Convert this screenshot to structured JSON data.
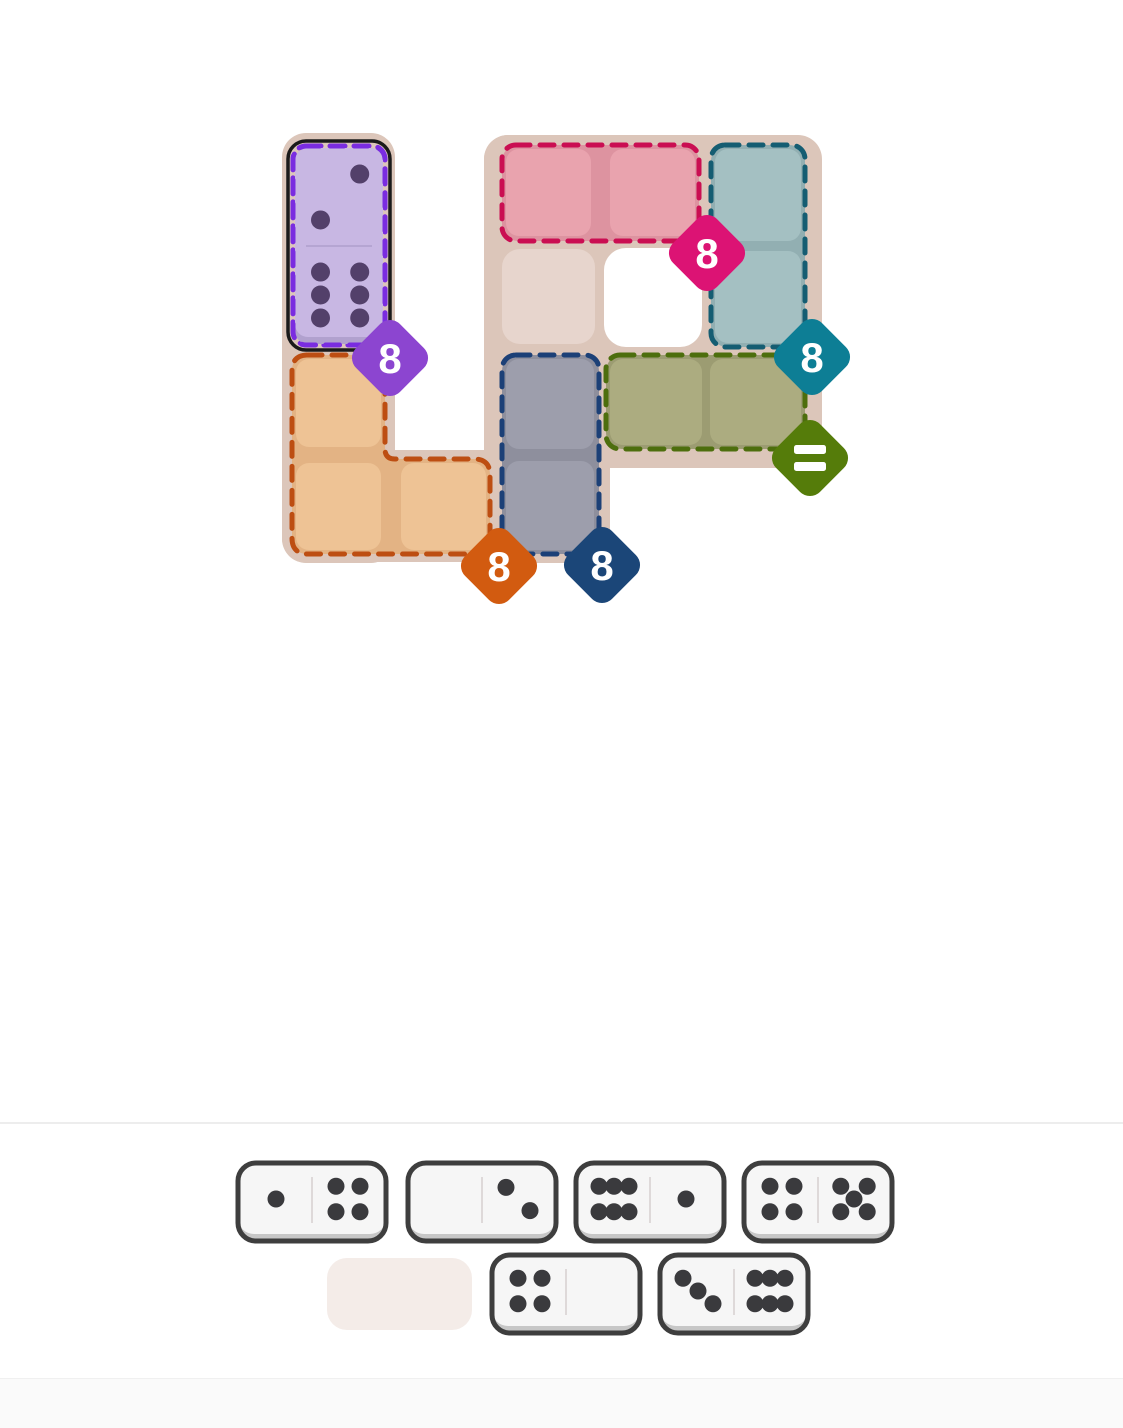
{
  "page": {
    "bg": "#ffffff"
  },
  "board": {
    "backing_color": "#dcc6ba",
    "backing_rects": [
      {
        "x": 282,
        "y": 133,
        "w": 113,
        "h": 430
      },
      {
        "x": 484,
        "y": 135,
        "w": 126,
        "h": 428
      },
      {
        "x": 484,
        "y": 135,
        "w": 338,
        "h": 333
      },
      {
        "x": 282,
        "y": 450,
        "w": 328,
        "h": 112
      }
    ],
    "hole": {
      "x": 604,
      "y": 248,
      "w": 98,
      "h": 99,
      "fill": "#ffffff"
    },
    "empty_cell": {
      "id": "cell-C2",
      "x": 502,
      "y": 249,
      "w": 93,
      "h": 95,
      "fill": "#e7d5cd"
    },
    "regions": [
      {
        "id": "purple",
        "cells": [
          "A1",
          "A2"
        ],
        "shape": "rect",
        "rect": [
          293,
          146,
          92,
          199
        ],
        "dash": "#7a2ce0",
        "selected": true,
        "selection_outline": "#1a1a1a",
        "badge": {
          "label": "8",
          "color": "#8c45d0",
          "x": 390,
          "y": 358
        }
      },
      {
        "id": "pink",
        "cells": [
          "C1",
          "D1"
        ],
        "shape": "rect",
        "rect": [
          502,
          145,
          197,
          96
        ],
        "base": "#dd93a0",
        "cell_fill": "#e9a3ae",
        "dash": "#ca0e52",
        "cells_px": [
          [
            506,
            149,
            85,
            87
          ],
          [
            610,
            149,
            85,
            87
          ]
        ],
        "badge": {
          "label": "8",
          "color": "#dc1374",
          "x": 707,
          "y": 253
        }
      },
      {
        "id": "teal",
        "cells": [
          "E1",
          "E2"
        ],
        "shape": "rect",
        "rect": [
          711,
          145,
          94,
          202
        ],
        "base": "#92afb2",
        "cell_fill": "#a4c0c2",
        "dash": "#155d72",
        "cells_px": [
          [
            715,
            149,
            86,
            92
          ],
          [
            715,
            251,
            86,
            92
          ]
        ],
        "badge": {
          "label": "8",
          "color": "#0d7e95",
          "x": 812,
          "y": 357
        }
      },
      {
        "id": "orange",
        "cells": [
          "A3",
          "A4",
          "B4"
        ],
        "shape": "path",
        "path": "M 308,355 L 369,355 Q 385,355 385,371 L 385,449 Q 385,459 395,459 L 474,459 Q 490,459 490,475 L 490,538 Q 490,554 474,554 L 308,554 Q 292,554 292,538 L 292,371 Q 292,355 308,355 Z",
        "base": "#e3b384",
        "cell_fill": "#eec395",
        "dash": "#bd4e12",
        "cells_px": [
          [
            296,
            359,
            85,
            88
          ],
          [
            296,
            463,
            85,
            87
          ],
          [
            401,
            463,
            85,
            87
          ]
        ],
        "badge": {
          "label": "8",
          "color": "#d25b10",
          "x": 499,
          "y": 566
        }
      },
      {
        "id": "navy",
        "cells": [
          "C3",
          "C4"
        ],
        "shape": "rect",
        "rect": [
          502,
          355,
          97,
          199
        ],
        "base": "#8e8f9d",
        "cell_fill": "#9d9eac",
        "dash": "#1c4077",
        "cells_px": [
          [
            506,
            359,
            88,
            90
          ],
          [
            506,
            461,
            88,
            89
          ]
        ],
        "badge": {
          "label": "8",
          "color": "#1b4678",
          "x": 602,
          "y": 565
        }
      },
      {
        "id": "olive",
        "cells": [
          "D3",
          "E3"
        ],
        "shape": "rect",
        "rect": [
          606,
          355,
          199,
          94
        ],
        "base": "#9c9c72",
        "cell_fill": "#acac80",
        "dash": "#4d6e0d",
        "cells_px": [
          [
            610,
            359,
            92,
            86
          ],
          [
            710,
            359,
            91,
            86
          ]
        ],
        "badge": {
          "label": "=",
          "color": "#557c0a",
          "x": 810,
          "y": 458
        }
      }
    ],
    "placed_domino": {
      "pips": [
        2,
        6
      ],
      "x": 295,
      "y": 148,
      "w": 88,
      "h": 196,
      "fill": "#c8b7e3",
      "lip": "#b1a1ce",
      "pip_color": "#53406a",
      "divider": "#b5a5d2",
      "selection_outline": {
        "x": 288,
        "y": 141,
        "w": 102,
        "h": 209,
        "color": "#1a1a1a"
      }
    }
  },
  "tray": {
    "style": {
      "w": 148,
      "h": 78,
      "fill": "#f6f6f6",
      "border": "#3e3e3e",
      "lip": "#c7c7c7",
      "pip": "#3a3a3d",
      "divider": "#ded9d9"
    },
    "empty_slot": {
      "x": 327,
      "y": 1258,
      "w": 145,
      "h": 72,
      "fill": "#f4ece8"
    },
    "dominoes": [
      {
        "x": 238,
        "y": 1163,
        "pips": [
          1,
          4
        ]
      },
      {
        "x": 408,
        "y": 1163,
        "pips": [
          0,
          2
        ]
      },
      {
        "x": 576,
        "y": 1163,
        "pips": [
          6,
          1
        ]
      },
      {
        "x": 744,
        "y": 1163,
        "pips": [
          4,
          5
        ]
      },
      {
        "x": 492,
        "y": 1255,
        "pips": [
          4,
          0
        ]
      },
      {
        "x": 660,
        "y": 1255,
        "pips": [
          3,
          6
        ]
      }
    ]
  },
  "chrome": {
    "tray_divider": {
      "y": 1122,
      "color": "#ededed"
    },
    "footer": {
      "y": 1378,
      "h": 50,
      "bg": "#fafafa",
      "border": "#f0f0f0"
    }
  }
}
